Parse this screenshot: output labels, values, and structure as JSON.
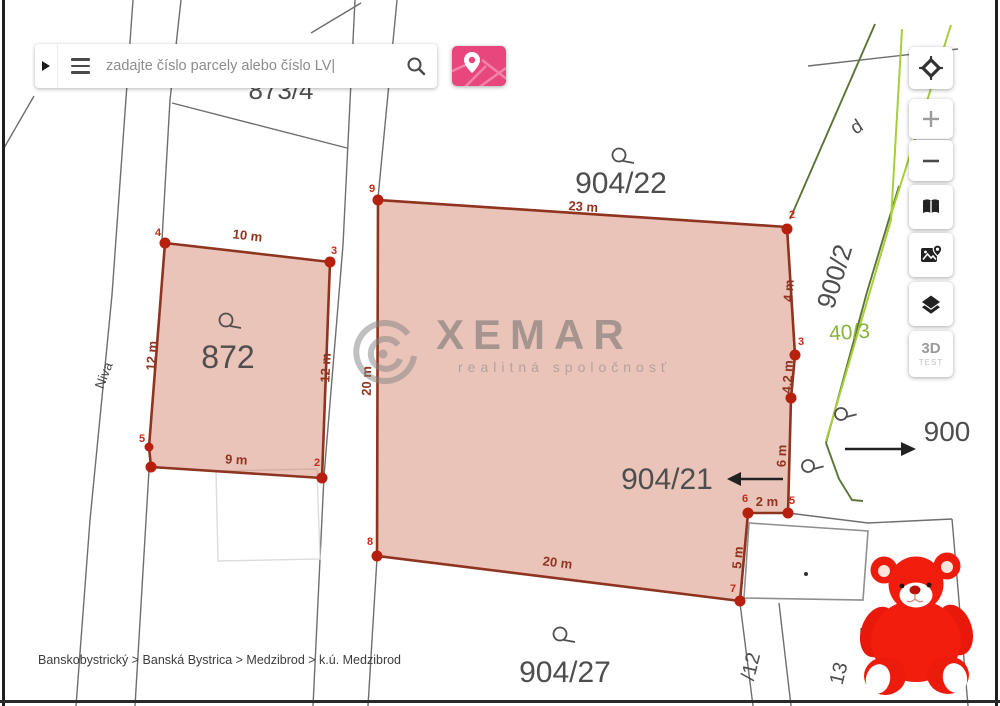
{
  "search": {
    "placeholder": "zadajte číslo parcely alebo číslo LV|"
  },
  "controls": {
    "zoom_in": "+",
    "zoom_out": "−",
    "threed_label": "3D",
    "threed_sub": "TEST"
  },
  "watermark": {
    "brand": "XEMAR",
    "tagline": "realitná spoločnosť"
  },
  "breadcrumb": {
    "text": "Banskobystrický > Banská Bystrica > Medzibrod > k.ú. Medzibrod"
  },
  "map": {
    "street": "Niva",
    "labels": {
      "l8734": "873/4",
      "l90422": "904/22",
      "l90421": "904/21",
      "l90427": "904/27",
      "l9002": "900/2",
      "l900": "900",
      "l403": "40/3",
      "l872": "872",
      "ld": "d",
      "l12": "/12",
      "l13": "13"
    },
    "p872": {
      "edge_top": "10 m",
      "edge_right": "12 m",
      "edge_bottom": "9 m",
      "edge_left": "12 m",
      "v2": "2",
      "v3": "3",
      "v4": "4",
      "v5": "5"
    },
    "p904": {
      "edge_top": "23 m",
      "edge_e23": "4 m",
      "edge_e34": "4,2 m",
      "edge_e45": "6 m",
      "edge_e56": "2 m",
      "edge_e67": "5 m",
      "edge_bottom": "20 m",
      "edge_left": "20 m",
      "v2": "2",
      "v3": "3",
      "v5": "5",
      "v6": "6",
      "v7": "7",
      "v8": "8",
      "v9": "9"
    },
    "colors": {
      "parcel_fill": "#f4cec2",
      "parcel_stroke": "#8e3420",
      "vertex_dot": "#b71f0e",
      "accent_pink": "#e8477d",
      "green_bright": "#a6cf3a",
      "green_dark": "#5c7537"
    }
  }
}
